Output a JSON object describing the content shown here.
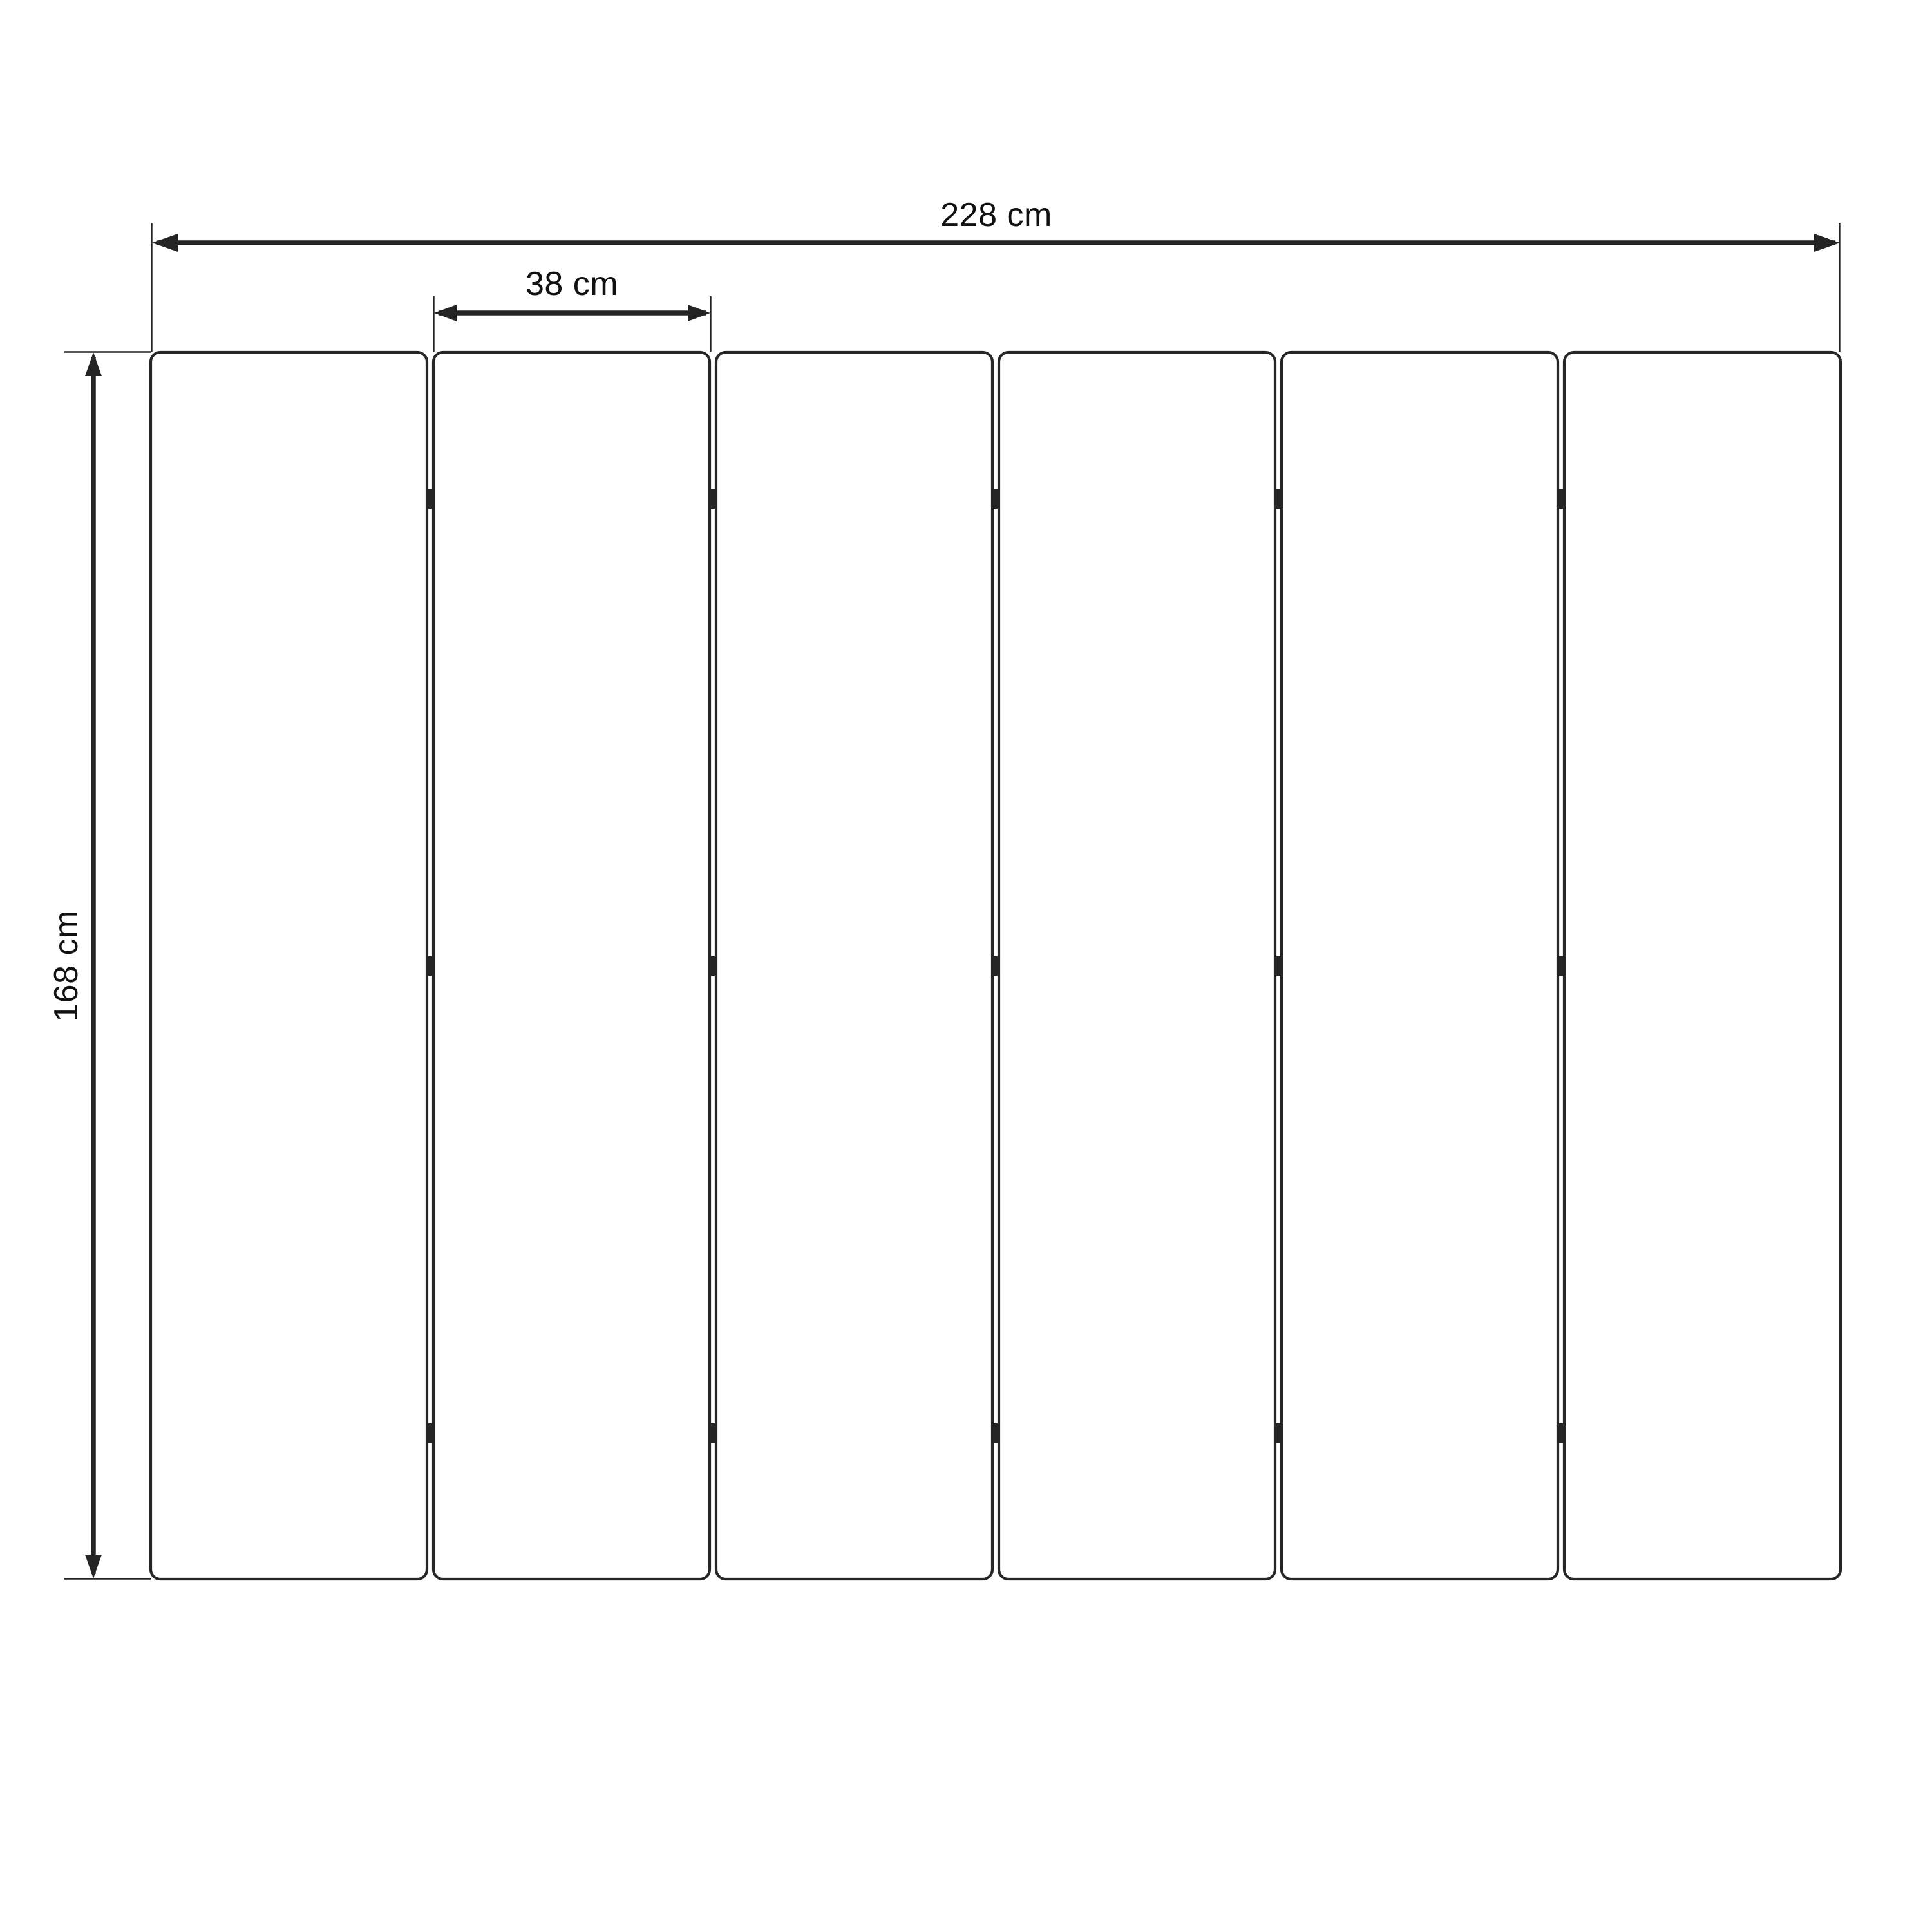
{
  "diagram": {
    "type": "technical-dimension-drawing",
    "panels": {
      "count": 6,
      "gaps": 5,
      "hinges_per_gap": 3
    },
    "dimensions": {
      "total_width": {
        "label": "228 cm",
        "value": 228,
        "unit": "cm",
        "orientation": "horizontal"
      },
      "panel_width": {
        "label": "38 cm",
        "value": 38,
        "unit": "cm",
        "orientation": "horizontal"
      },
      "height": {
        "label": "168 cm",
        "value": 168,
        "unit": "cm",
        "orientation": "vertical"
      }
    },
    "colors": {
      "background": "#ffffff",
      "line": "#242424",
      "text": "#111111"
    }
  }
}
